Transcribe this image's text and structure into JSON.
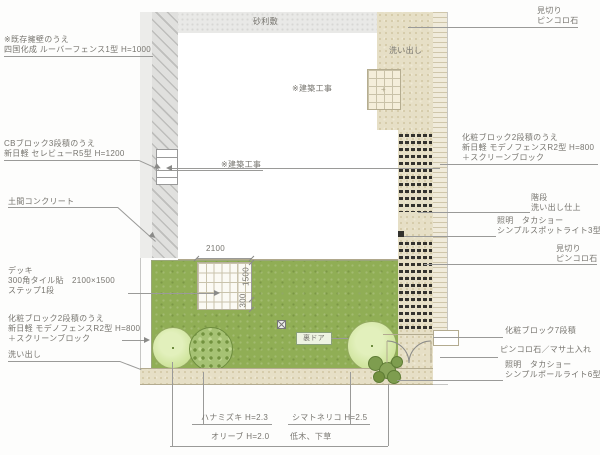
{
  "title": "庭園 外構 平面図",
  "colors": {
    "lawn": "#90ae55",
    "washout_beige": "#e6dfc6",
    "gravel_gray": "#e9e9e7",
    "wall_gray": "#e0e0de",
    "tree_light": "#d7e8aa",
    "tree_medium": "#a6c274",
    "shrub_dark": "#7e9d4f",
    "line": "#9a9a98",
    "text": "#77756f",
    "block_dark": "#33322e"
  },
  "plan": {
    "gravel_label": "砂利敷",
    "washout_label": "洗い出し",
    "building_label1": "※建築工事",
    "building_label2": "※建築工事",
    "door_label": "裏ドア",
    "dim_width": "2100",
    "dim_deck": "1500",
    "dim_step": "300"
  },
  "labels_left": [
    {
      "lines": [
        "※既存擁壁のうえ",
        "四国化成 ルーバーフェンス1型 H=1000"
      ]
    },
    {
      "lines": [
        "CBブロック3段積のうえ",
        "新日軽 セレビューR5型 H=1200"
      ]
    },
    {
      "lines": [
        "土間コンクリート"
      ]
    },
    {
      "lines": [
        "デッキ",
        "300角タイル貼　2100×1500",
        "ステップ1段"
      ]
    },
    {
      "lines": [
        "化粧ブロック2段積のうえ",
        "新日軽 モデノフェンスR2型 H=800",
        "＋スクリーンブロック"
      ]
    },
    {
      "lines": [
        "洗い出し"
      ]
    }
  ],
  "labels_right": [
    {
      "lines": [
        "見切り",
        "ピンコロ石"
      ]
    },
    {
      "lines": [
        "化粧ブロック2段積のうえ",
        "新日軽 モデノフェンスR2型 H=800",
        "＋スクリーンブロック"
      ]
    },
    {
      "lines": [
        "階段",
        "洗い出し仕上"
      ]
    },
    {
      "lines": [
        "照明　タカショー",
        "シンプルスポットライト3型"
      ]
    },
    {
      "lines": [
        "見切り",
        "ピンコロ石"
      ]
    },
    {
      "lines": [
        "化粧ブロック7段積"
      ]
    },
    {
      "lines": [
        "ピンコロ石／マサ土入れ"
      ]
    },
    {
      "lines": [
        "照明　タカショー",
        "シンプルポールライト6型"
      ]
    }
  ],
  "labels_bottom": [
    "ハナミズキ H=2.3",
    "シマトネリコ H=2.5",
    "オリーブ H=2.0",
    "低木、下草"
  ]
}
